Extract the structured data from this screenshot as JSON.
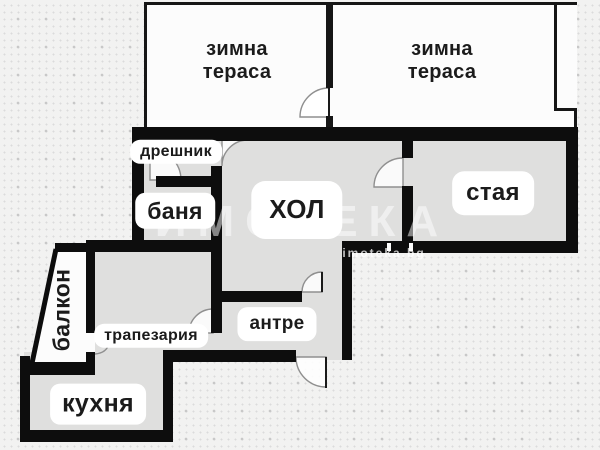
{
  "palette": {
    "background": "#f2f2f1",
    "dots": "#c8c8c8",
    "wall": "#0d0d0d",
    "floor": "#dfdfde",
    "terrace_floor": "#fcfcfc",
    "label_bg": "#ffffff",
    "label_text": "#1b1b1b",
    "door_arc": "#8f8f8f"
  },
  "rooms": {
    "terrace_left": {
      "label": "зимна тераса"
    },
    "terrace_right": {
      "label": "зимна тераса"
    },
    "closet": {
      "label": "дрешник"
    },
    "bathroom": {
      "label": "баня"
    },
    "living_room": {
      "label": "ХОЛ"
    },
    "bedroom": {
      "label": "стая"
    },
    "balcony": {
      "label": "балкон"
    },
    "dining": {
      "label": "трапезария"
    },
    "hallway": {
      "label": "антре"
    },
    "kitchen": {
      "label": "кухня"
    }
  },
  "watermark": {
    "brand": "ИМОТЕКА",
    "site": "imoteka.bg"
  }
}
